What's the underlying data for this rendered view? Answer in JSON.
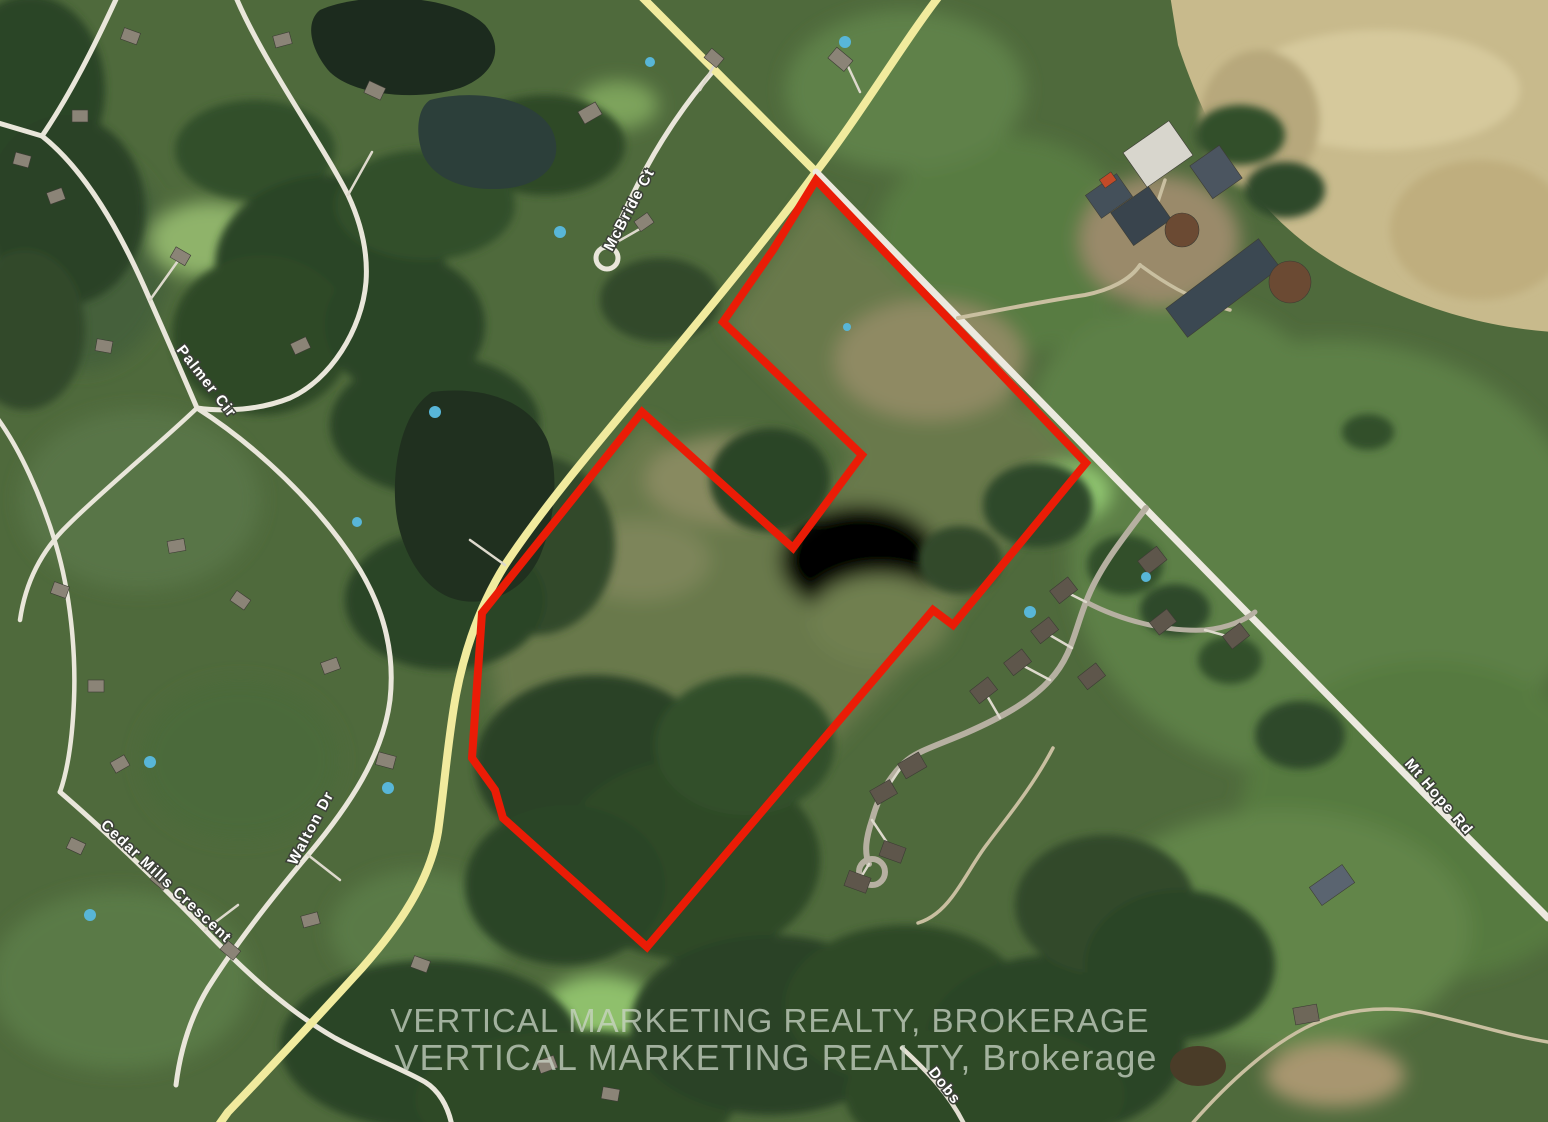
{
  "map": {
    "view": "satellite-aerial",
    "boundary": {
      "color": "#ea1c06",
      "style": "property-outline"
    },
    "road_labels": {
      "mcbride": "McBride Ct",
      "palmer": "Palmer Cir",
      "walton": "Walton Dr",
      "cedar_mills": "Cedar Mills Crescent",
      "mt_hope": "Mt Hope Rd",
      "dobs": "Dobs"
    },
    "watermark": {
      "line1": "VERTICAL MARKETING REALTY, BROKERAGE",
      "line2": "VERTICAL MARKETING REALTY, Brokerage"
    }
  }
}
